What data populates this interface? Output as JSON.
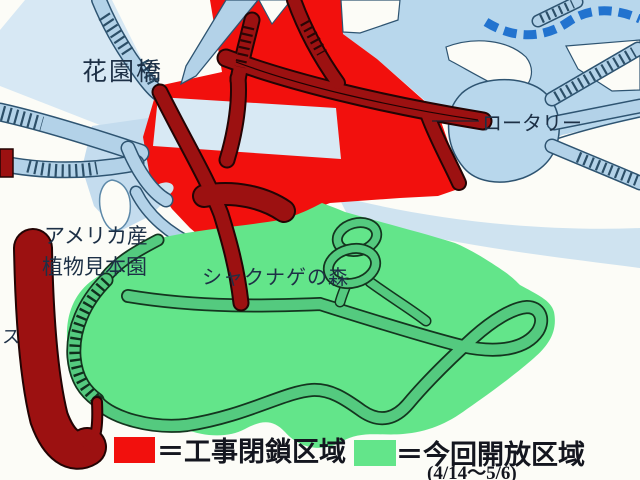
{
  "title": "park construction closure map",
  "colors": {
    "closed_red": "#f2100d",
    "closed_road_maroon": "#9c1111",
    "open_green": "#63e58a",
    "open_path_green": "#54ca7f",
    "road_blue": "#b3d2e8",
    "field_blue": "#b8d7ec",
    "band_blue": "#d7e8f4",
    "outline_navy": "#2e5471",
    "stream_blue": "#2273cf",
    "label_navy": "#1d3046",
    "legend_text": "#14161f"
  },
  "labels": {
    "bridge": "花園橋",
    "rotary": "ロータリー",
    "garden_line1": "アメリカ産",
    "garden_line2": "植物見本園",
    "forest": "シャクナゲの森",
    "left_edge_partial": "ス"
  },
  "legend": {
    "closed_label": "＝工事閉鎖区域",
    "open_label": "＝今回開放区域",
    "open_dates": "(4/14～5/6)"
  }
}
